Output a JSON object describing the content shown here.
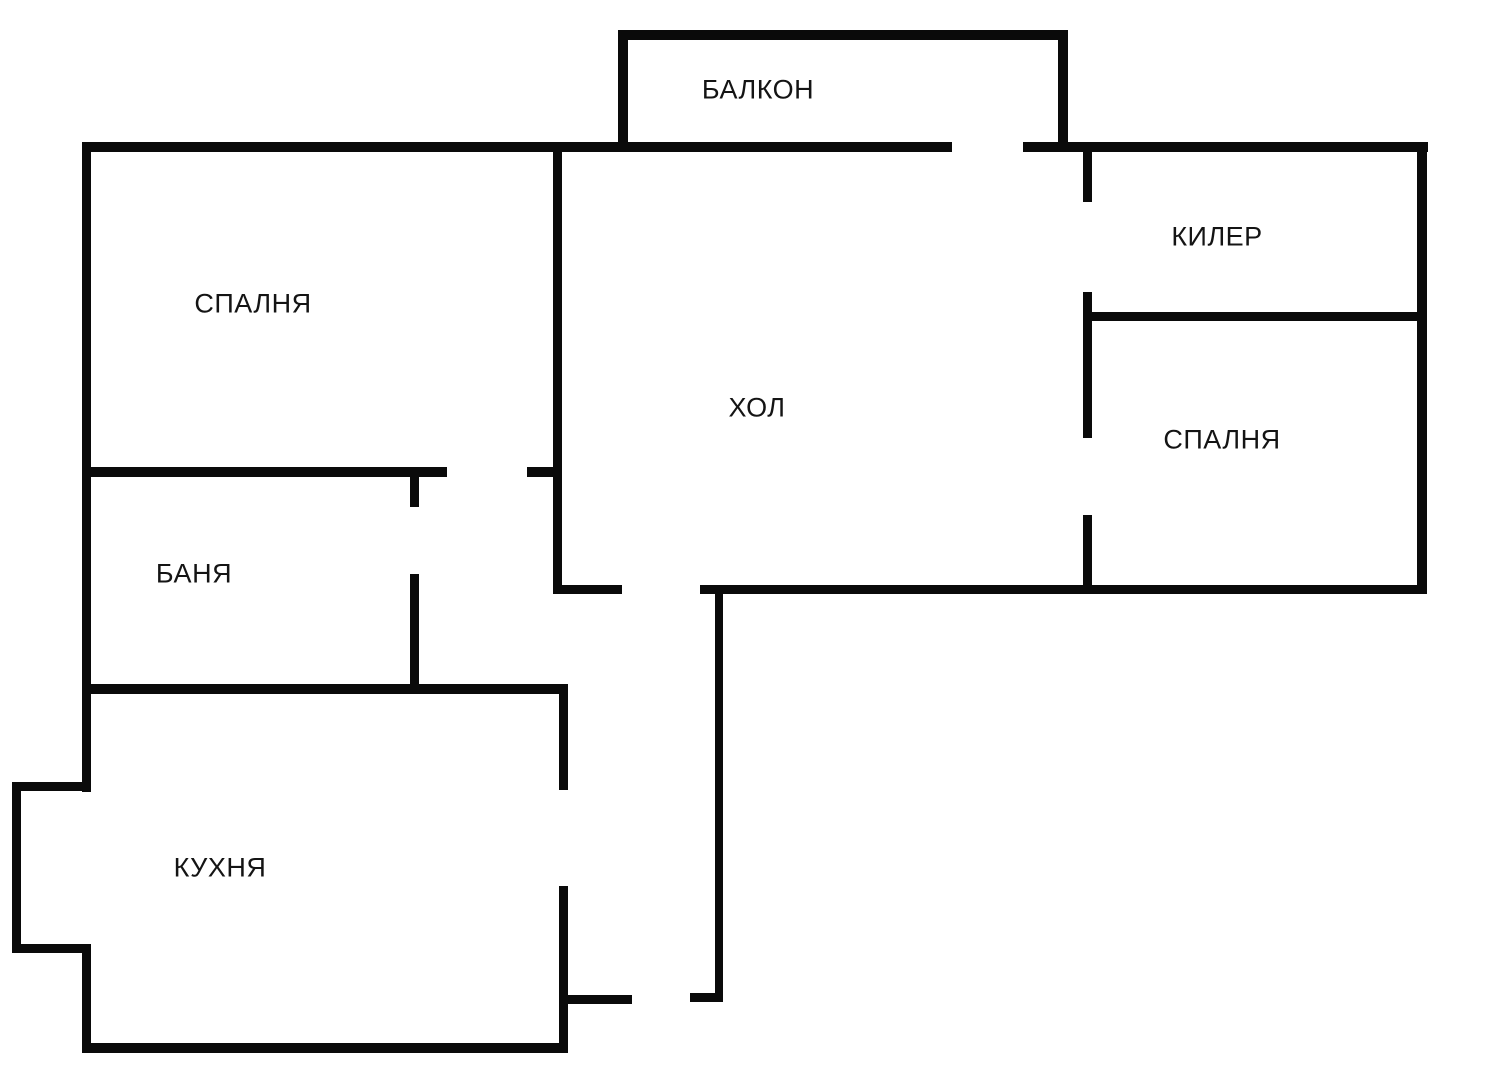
{
  "plan": {
    "width": 1500,
    "height": 1069,
    "background_color": "#ffffff",
    "wall_color": "#0a0a0a",
    "label_color": "#141414"
  },
  "rooms": [
    {
      "id": "balcony",
      "label": "БАЛКОН",
      "cx": 758,
      "cy": 90
    },
    {
      "id": "bedroom-left",
      "label": "СПАЛНЯ",
      "cx": 253,
      "cy": 304
    },
    {
      "id": "closet",
      "label": "КИЛЕР",
      "cx": 1217,
      "cy": 237
    },
    {
      "id": "hall",
      "label": "ХОЛ",
      "cx": 757,
      "cy": 408
    },
    {
      "id": "bedroom-right",
      "label": "СПАЛНЯ",
      "cx": 1222,
      "cy": 440
    },
    {
      "id": "bathroom",
      "label": "БАНЯ",
      "cx": 194,
      "cy": 574
    },
    {
      "id": "kitchen",
      "label": "КУХНЯ",
      "cx": 220,
      "cy": 868
    }
  ],
  "walls": [
    {
      "name": "top-wall-left-and-balcony-bottom",
      "x": 82,
      "y": 142,
      "w": 870,
      "h": 10
    },
    {
      "name": "top-wall-right",
      "x": 1023,
      "y": 142,
      "w": 405,
      "h": 10
    },
    {
      "name": "balcony-top",
      "x": 618,
      "y": 30,
      "w": 450,
      "h": 10
    },
    {
      "name": "balcony-left",
      "x": 618,
      "y": 30,
      "w": 10,
      "h": 122
    },
    {
      "name": "balcony-right",
      "x": 1058,
      "y": 30,
      "w": 10,
      "h": 122
    },
    {
      "name": "left-wall-upper",
      "x": 82,
      "y": 142,
      "w": 9,
      "h": 650
    },
    {
      "name": "bedroom-left-bottom-a",
      "x": 82,
      "y": 467,
      "w": 365,
      "h": 10
    },
    {
      "name": "bedroom-left-bottom-b",
      "x": 527,
      "y": 467,
      "w": 35,
      "h": 10
    },
    {
      "name": "bedroom-left-right-wall",
      "x": 553,
      "y": 142,
      "w": 9,
      "h": 452
    },
    {
      "name": "bathroom-right-jamb-upper",
      "x": 410,
      "y": 467,
      "w": 9,
      "h": 40
    },
    {
      "name": "bathroom-right-lower",
      "x": 410,
      "y": 574,
      "w": 9,
      "h": 115
    },
    {
      "name": "bathroom-bottom-kitchen-top",
      "x": 82,
      "y": 684,
      "w": 486,
      "h": 10
    },
    {
      "name": "kitchen-bump-top",
      "x": 12,
      "y": 782,
      "w": 79,
      "h": 9
    },
    {
      "name": "kitchen-bump-left",
      "x": 12,
      "y": 782,
      "w": 9,
      "h": 171
    },
    {
      "name": "kitchen-bump-bottom",
      "x": 12,
      "y": 944,
      "w": 79,
      "h": 9
    },
    {
      "name": "left-wall-lower",
      "x": 82,
      "y": 944,
      "w": 9,
      "h": 109
    },
    {
      "name": "kitchen-bottom",
      "x": 82,
      "y": 1043,
      "w": 486,
      "h": 10
    },
    {
      "name": "kitchen-right-upper",
      "x": 559,
      "y": 684,
      "w": 9,
      "h": 106
    },
    {
      "name": "kitchen-right-lower",
      "x": 559,
      "y": 886,
      "w": 9,
      "h": 166
    },
    {
      "name": "entry-stub-left",
      "x": 559,
      "y": 995,
      "w": 73,
      "h": 9
    },
    {
      "name": "entry-stub-right",
      "x": 690,
      "y": 993,
      "w": 33,
      "h": 9
    },
    {
      "name": "hall-bottom-foot",
      "x": 553,
      "y": 585,
      "w": 69,
      "h": 9
    },
    {
      "name": "hall-bottom-main",
      "x": 700,
      "y": 585,
      "w": 723,
      "h": 9
    },
    {
      "name": "corridor-wall",
      "x": 715,
      "y": 588,
      "w": 8,
      "h": 414
    },
    {
      "name": "hall-right-wall-a",
      "x": 1083,
      "y": 142,
      "w": 9,
      "h": 60
    },
    {
      "name": "hall-right-wall-b",
      "x": 1083,
      "y": 292,
      "w": 9,
      "h": 146
    },
    {
      "name": "hall-right-wall-c",
      "x": 1083,
      "y": 515,
      "w": 9,
      "h": 79
    },
    {
      "name": "closet-bottom-divider",
      "x": 1087,
      "y": 312,
      "w": 336,
      "h": 9
    },
    {
      "name": "right-wall",
      "x": 1417,
      "y": 142,
      "w": 10,
      "h": 452
    }
  ]
}
